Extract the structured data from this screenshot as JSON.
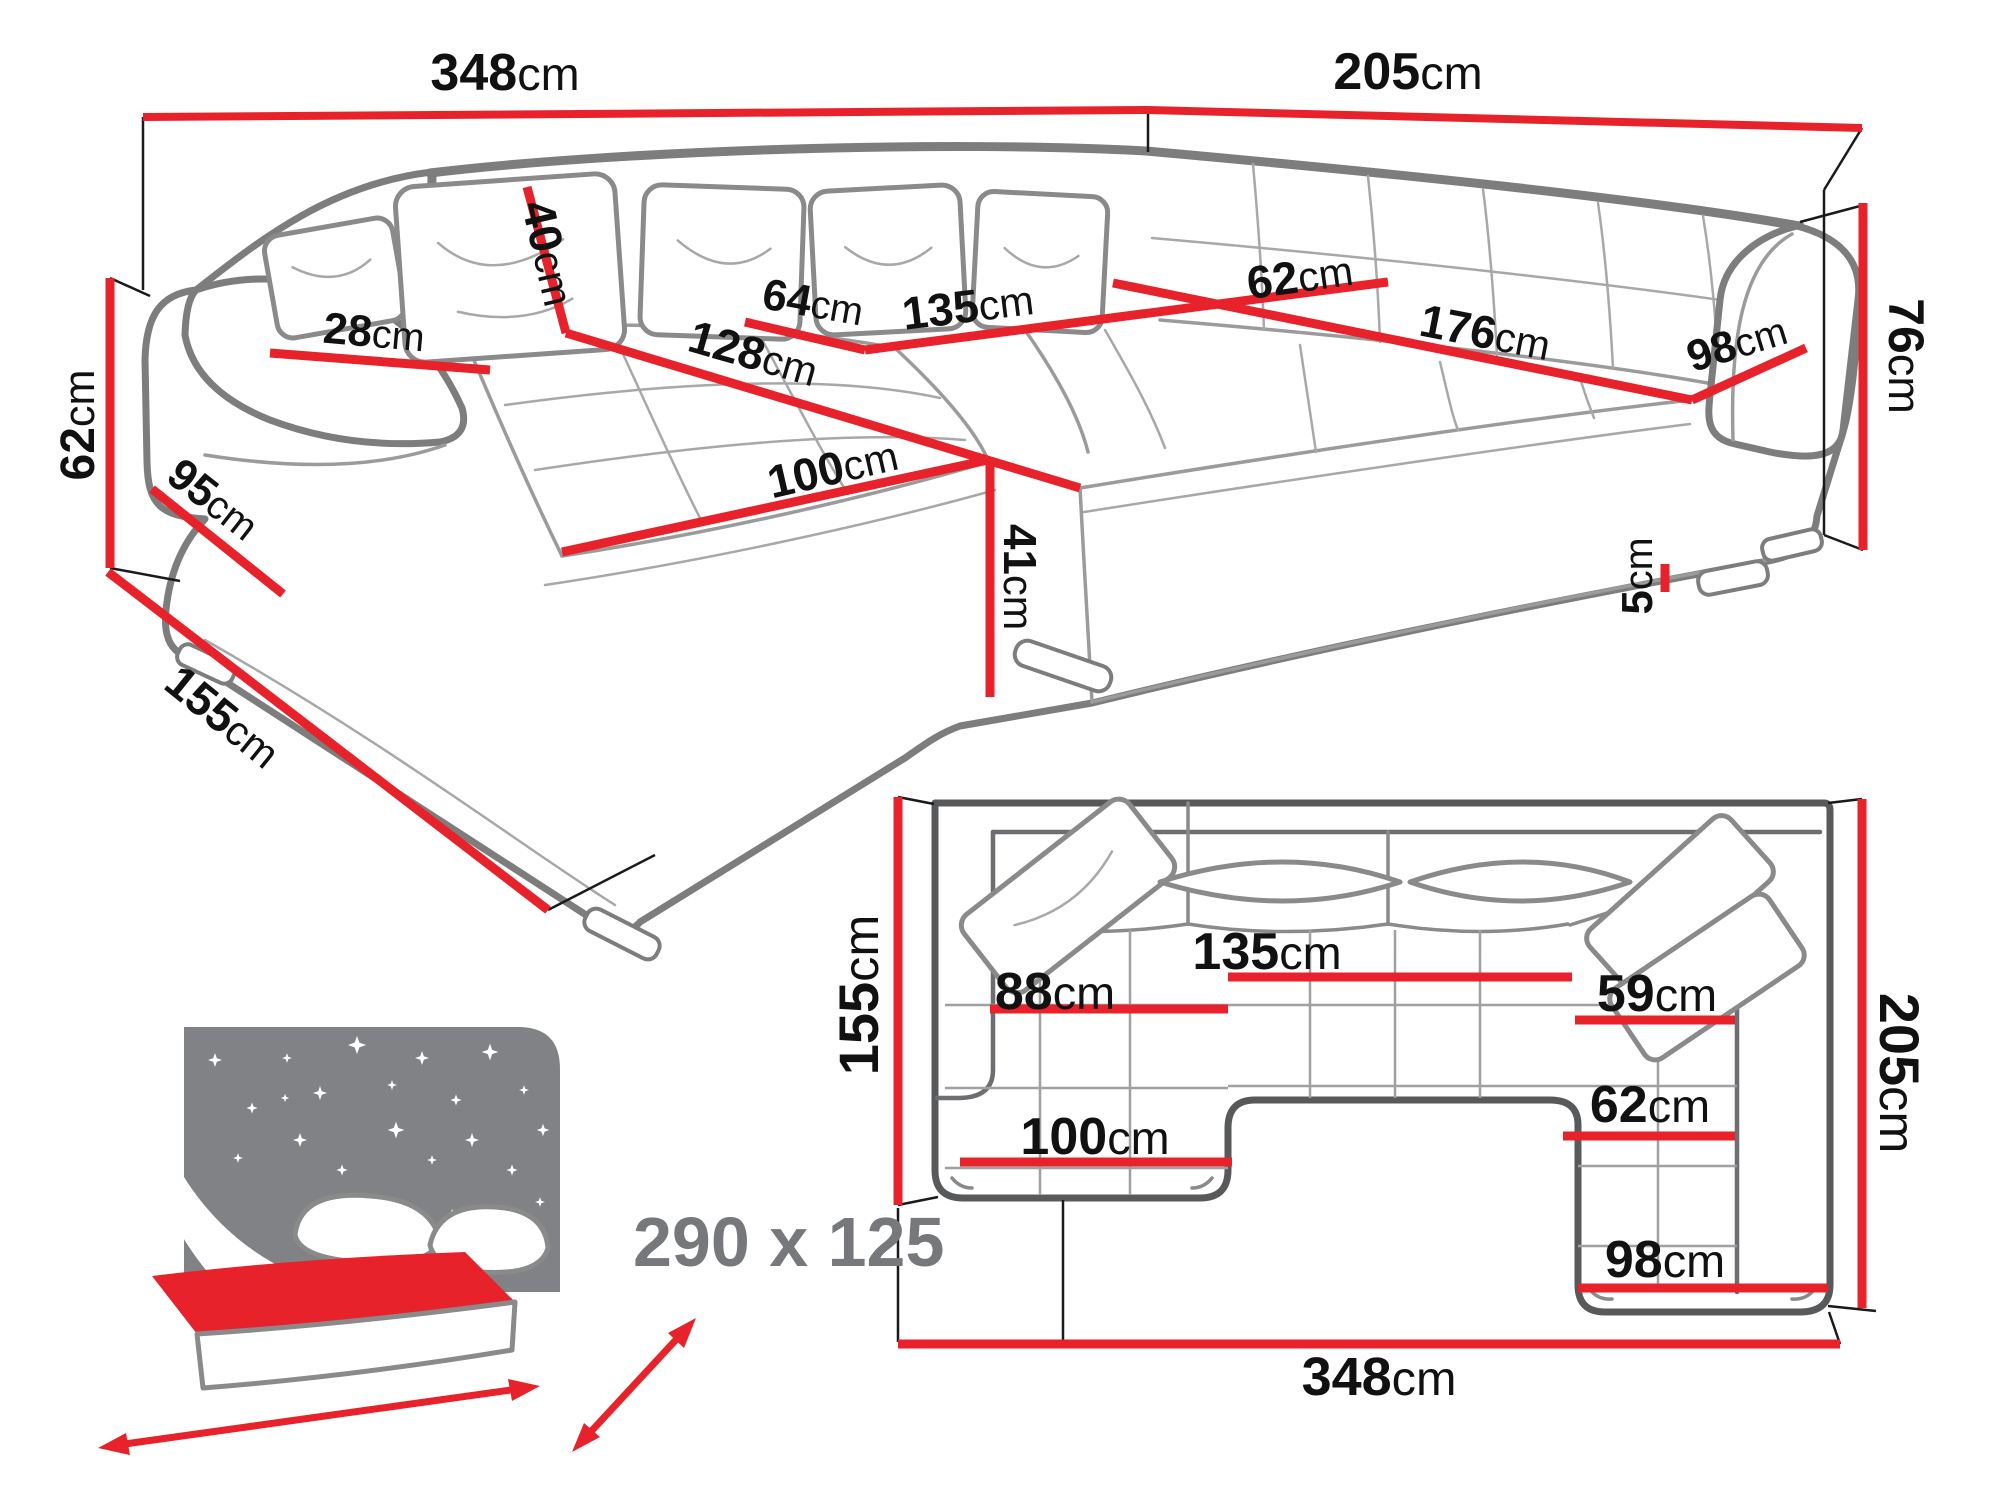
{
  "perspective_view": {
    "dims": {
      "back_width": {
        "v": "348",
        "u": "cm"
      },
      "right_depth": {
        "v": "205",
        "u": "cm"
      },
      "pillow_h": {
        "v": "40",
        "u": "cm"
      },
      "armrest_w": {
        "v": "28",
        "u": "cm"
      },
      "arm_h": {
        "v": "62",
        "u": "cm"
      },
      "seg64": {
        "v": "64",
        "u": "cm"
      },
      "seg135": {
        "v": "135",
        "u": "cm"
      },
      "seg62": {
        "v": "62",
        "u": "cm"
      },
      "seg176": {
        "v": "176",
        "u": "cm"
      },
      "seg98": {
        "v": "98",
        "u": "cm"
      },
      "back_h": {
        "v": "76",
        "u": "cm"
      },
      "chaise_len": {
        "v": "128",
        "u": "cm"
      },
      "side95": {
        "v": "95",
        "u": "cm"
      },
      "chaise_w": {
        "v": "100",
        "u": "cm"
      },
      "seat_h": {
        "v": "41",
        "u": "cm"
      },
      "leg_h": {
        "v": "5",
        "u": "cm"
      },
      "side_depth": {
        "v": "155",
        "u": "cm"
      }
    }
  },
  "top_view": {
    "dims": {
      "left_depth": {
        "v": "155",
        "u": "cm"
      },
      "chaise_seat_w": {
        "v": "88",
        "u": "cm"
      },
      "mid_seat_w": {
        "v": "135",
        "u": "cm"
      },
      "corner_seat_w": {
        "v": "59",
        "u": "cm"
      },
      "right_depth": {
        "v": "205",
        "u": "cm"
      },
      "right_seat_w": {
        "v": "62",
        "u": "cm"
      },
      "chaise_w": {
        "v": "100",
        "u": "cm"
      },
      "right_w": {
        "v": "98",
        "u": "cm"
      },
      "total_width": {
        "v": "348",
        "u": "cm"
      }
    }
  },
  "sleeping_function": {
    "size_label": "290 x 125"
  },
  "colors": {
    "dimension_red": "#e8222a",
    "outline_gray": "#7d7d7d",
    "plan_outline": "#58595b",
    "label_black": "#111111",
    "icon_gray": "#808285",
    "bed_text_gray": "#77787b"
  }
}
